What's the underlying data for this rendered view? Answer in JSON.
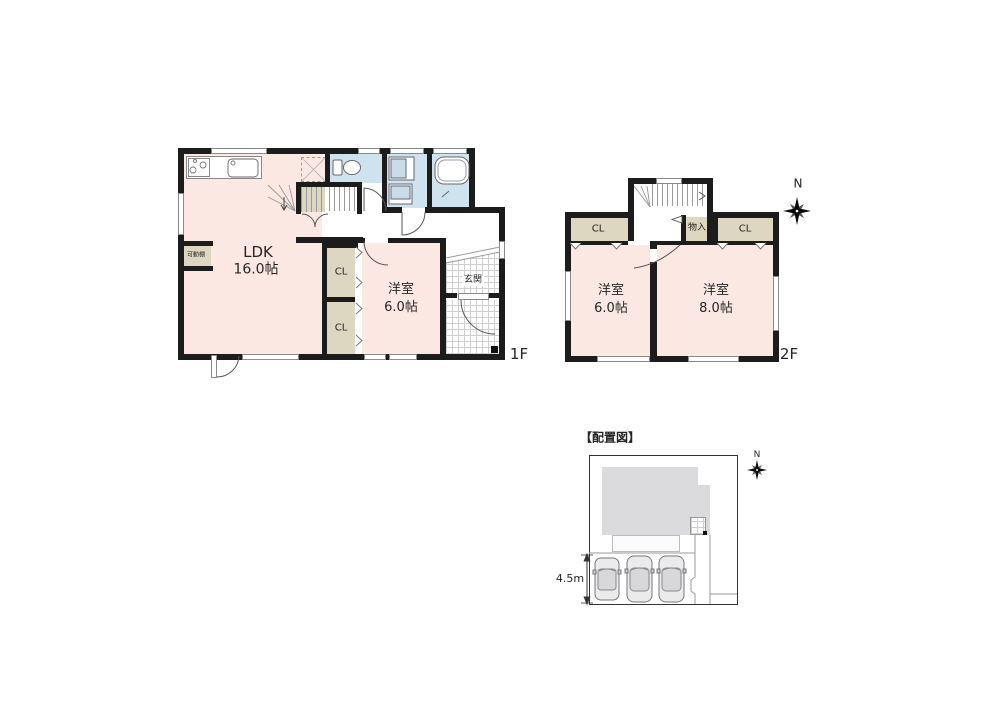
{
  "palette": {
    "room_pink": "#fbe8e2",
    "closet_tan": "#ddd6c0",
    "wet_area_blue": "#cfe3ef",
    "wall_black": "#1c1c1c",
    "building_gray": "#dbdbdd"
  },
  "floor1": {
    "floor_label": "1F",
    "ldk": {
      "name": "LDK",
      "size": "16.0帖"
    },
    "bedroom": {
      "name": "洋室",
      "size": "6.0帖"
    },
    "closet_upper": "CL",
    "closet_lower": "CL",
    "movable_shelf": "可動棚",
    "entrance": "玄関"
  },
  "floor2": {
    "floor_label": "2F",
    "bedroom_left": {
      "name": "洋室",
      "size": "6.0帖"
    },
    "bedroom_right": {
      "name": "洋室",
      "size": "8.0帖"
    },
    "closet_left": "CL",
    "closet_right": "CL",
    "storage": "物入",
    "compass_north": "N"
  },
  "site_plan": {
    "title": "【配置図】",
    "parking_depth": "4.5m",
    "compass_north": "N",
    "car_count": 3
  }
}
